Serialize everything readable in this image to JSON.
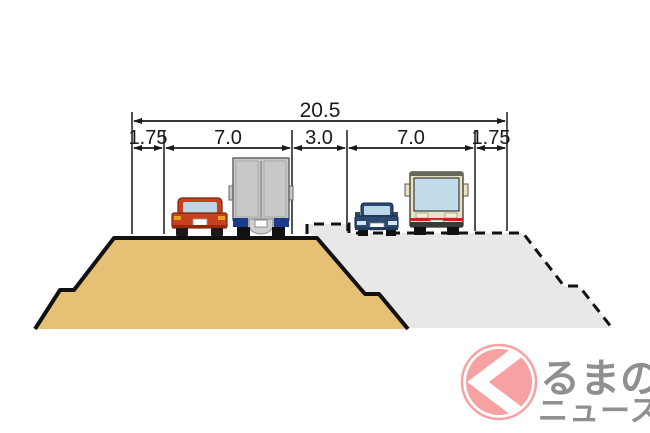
{
  "diagram": {
    "total_width_label": "20.5",
    "segment_labels": [
      "1.75",
      "7.0",
      "3.0",
      "7.0",
      "1.75"
    ],
    "description": "road-embankment-cross-section",
    "vehicles": [
      "red-car-rear",
      "truck-rear",
      "blue-car-front",
      "bus-front"
    ]
  },
  "logo": {
    "symbol": "ku-chevron-circle",
    "line1": "るまの",
    "line2": "ニュース"
  },
  "colors": {
    "embankment_fill": "#e6c175",
    "future_embankment_fill": "#e8e8e8",
    "outline_black": "#111111",
    "dimension_line": "#1a1a1a",
    "logo_pink": "#f7a2a2",
    "logo_text_gray": "#8f8f8f",
    "red_car": "#c8401e",
    "blue_car": "#2b4a72",
    "truck_gray": "#c8c8c8",
    "bus_cream": "#e9e2c4",
    "bus_stripe_red": "#cc2222",
    "window_blue": "#c3dcea"
  }
}
